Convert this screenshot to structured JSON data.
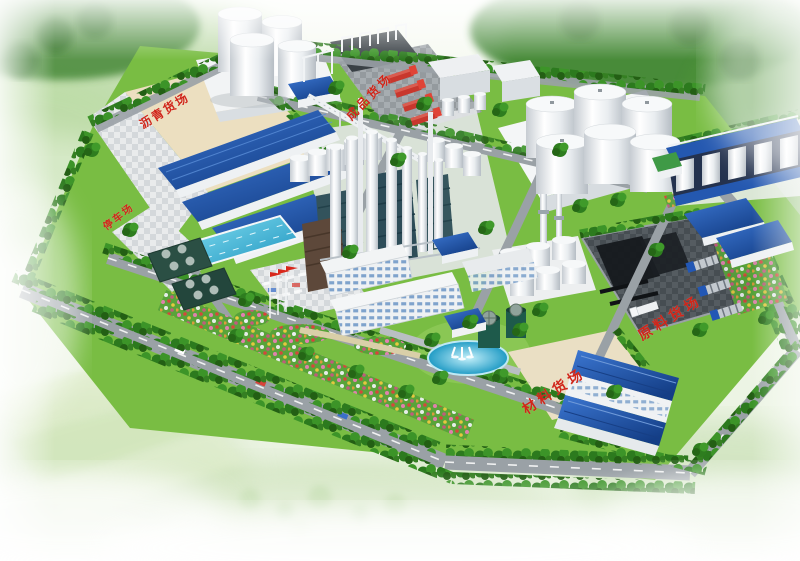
{
  "scene": {
    "type": "aerial-3d-architectural-rendering",
    "subject": "Bird's-eye rendering of an industrial plant campus with yards, silos, process towers and tree-lined roads"
  },
  "labels": {
    "asphalt_yard": "沥青货场",
    "parking_lot": "停车场",
    "finished_goods_yard": "成品货场",
    "raw_material_yard": "原料货场",
    "material_yard": "材料货场"
  },
  "colors": {
    "label_red": "#d0261a",
    "roof_blue": "#1d55a8",
    "lawn_green": "#79bd43",
    "tree_green": "#2c7a1e",
    "road_gray": "#9aa1a6",
    "yard_beige": "#ecdfc0",
    "water_cyan": "#2fb3dc",
    "tank_white": "#f2f4f6"
  }
}
